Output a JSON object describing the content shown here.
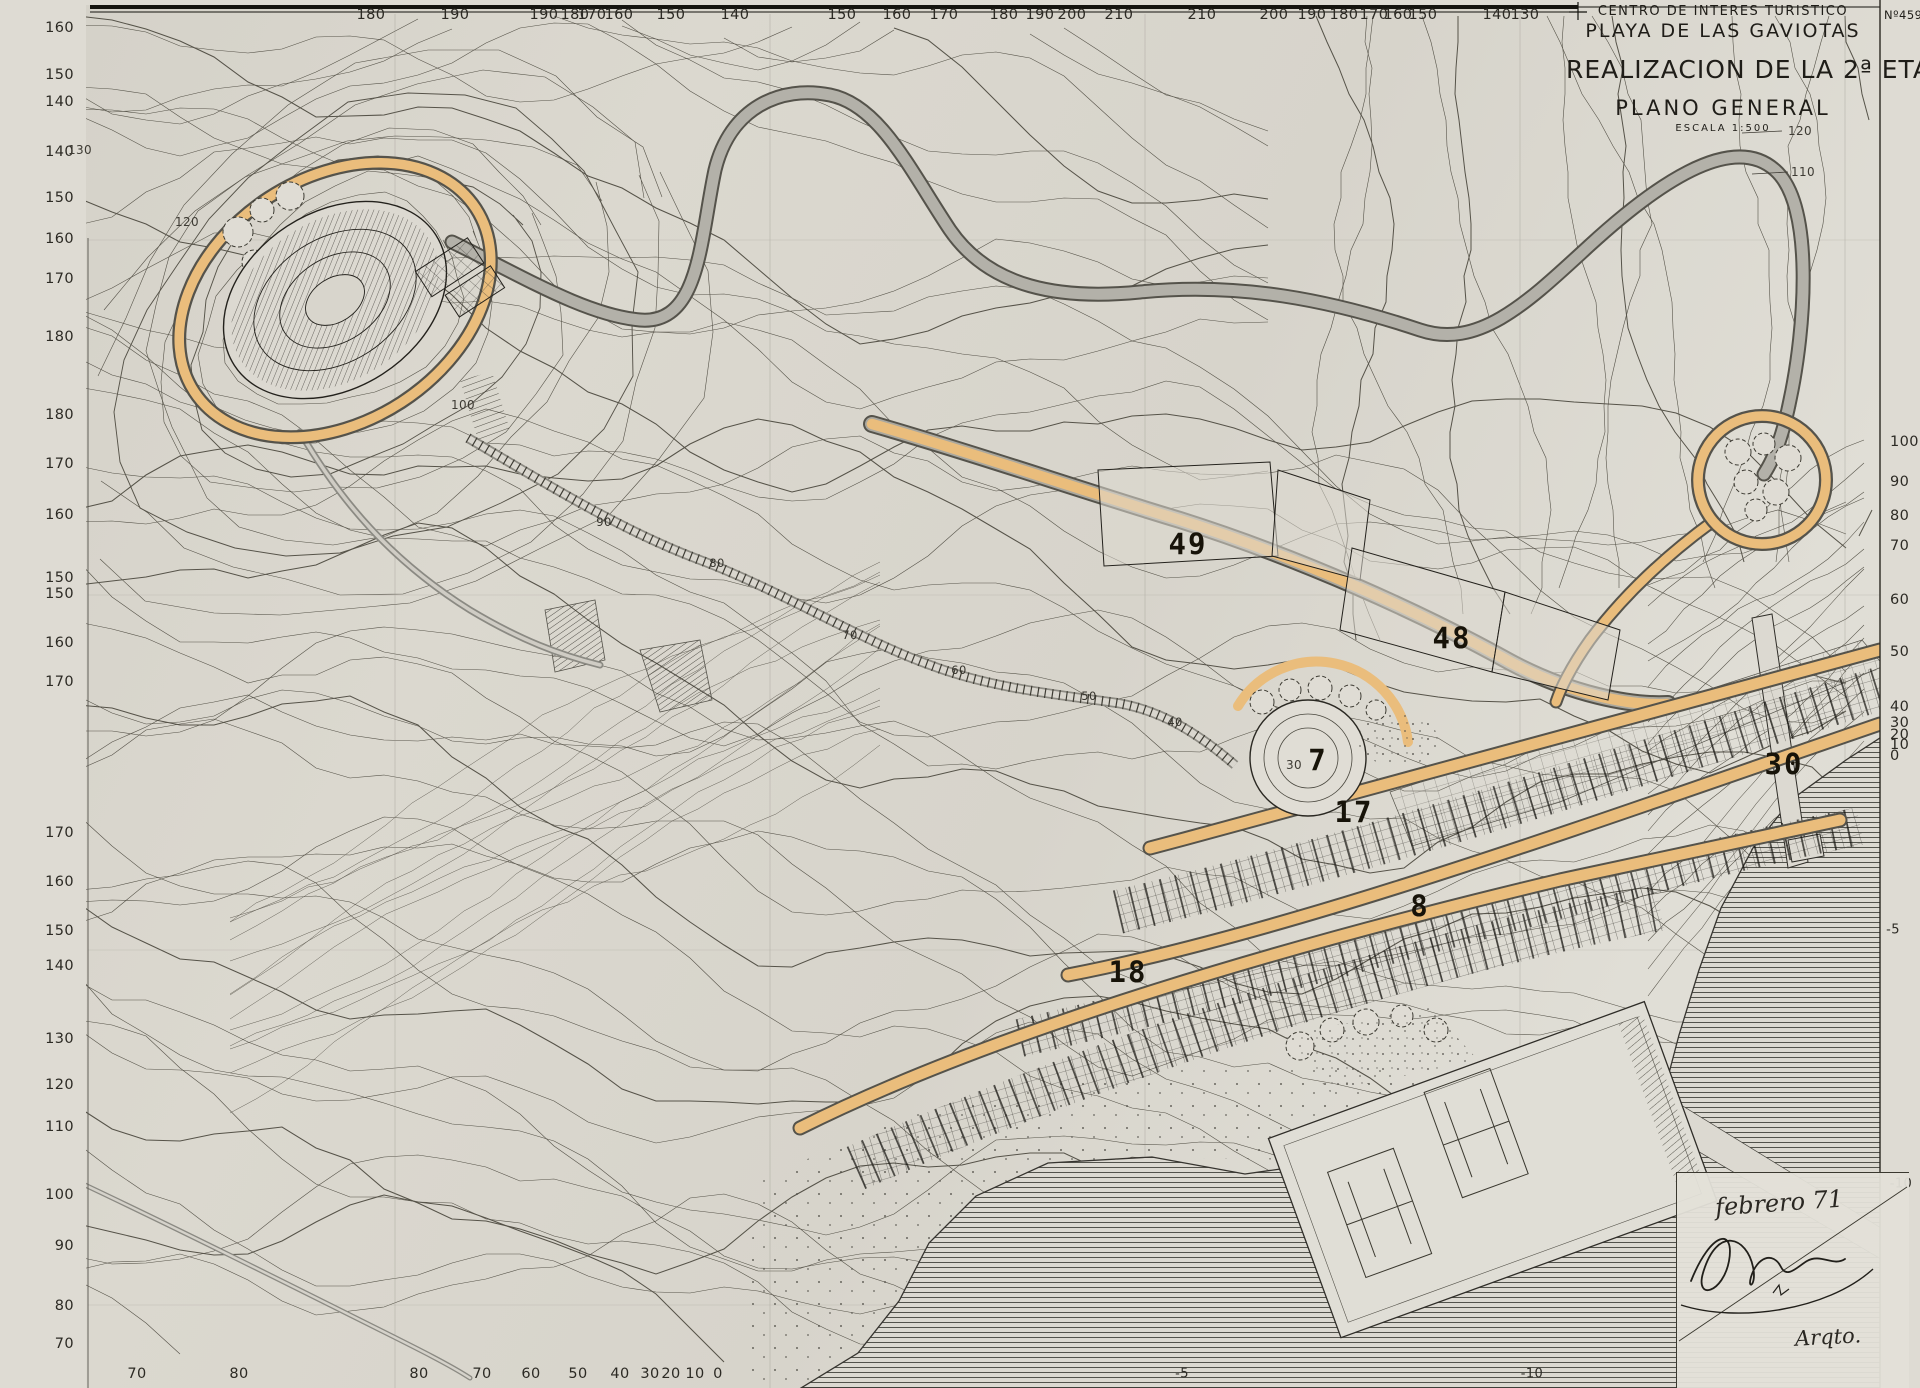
{
  "colors": {
    "paper": "#d8d5cc",
    "paper_light": "#e2dfd7",
    "margin": "#dedbd3",
    "ink": "#1f1d18",
    "contour": "#565349",
    "contour_index": "#45433b",
    "orange": "#eabd7c",
    "road_gray": "#aaa89f",
    "road_dark": "#55534b",
    "sea_line": "#43423c",
    "label": "#2c2a24",
    "stencil": "#171309"
  },
  "title_block": {
    "sheet_number": "Nº459",
    "line1": "CENTRO DE INTERES TURISTICO",
    "line2": "PLAYA DE LAS GAVIOTAS",
    "line3": "REALIZACION DE LA 2ª ETAPA",
    "line4": "PLANO GENERAL",
    "scale": "ESCALA 1:500"
  },
  "signature_block": {
    "date": "febrero 71",
    "credential": "Arqto."
  },
  "labels": {
    "top": [
      {
        "text": "180",
        "x": 371,
        "y": 15
      },
      {
        "text": "190",
        "x": 455,
        "y": 15
      },
      {
        "text": "190",
        "x": 544,
        "y": 15
      },
      {
        "text": "180",
        "x": 575,
        "y": 15
      },
      {
        "text": "170",
        "x": 592,
        "y": 15
      },
      {
        "text": "160",
        "x": 619,
        "y": 15
      },
      {
        "text": "150",
        "x": 671,
        "y": 15
      },
      {
        "text": "140",
        "x": 735,
        "y": 15
      },
      {
        "text": "150",
        "x": 842,
        "y": 15
      },
      {
        "text": "160",
        "x": 897,
        "y": 15
      },
      {
        "text": "170",
        "x": 944,
        "y": 15
      },
      {
        "text": "180",
        "x": 1004,
        "y": 15
      },
      {
        "text": "190",
        "x": 1040,
        "y": 15
      },
      {
        "text": "200",
        "x": 1072,
        "y": 15
      },
      {
        "text": "210",
        "x": 1119,
        "y": 15
      },
      {
        "text": "210",
        "x": 1202,
        "y": 15
      },
      {
        "text": "200",
        "x": 1274,
        "y": 15
      },
      {
        "text": "190",
        "x": 1312,
        "y": 15
      },
      {
        "text": "180",
        "x": 1344,
        "y": 15
      },
      {
        "text": "170",
        "x": 1374,
        "y": 15
      },
      {
        "text": "160",
        "x": 1398,
        "y": 15
      },
      {
        "text": "150",
        "x": 1423,
        "y": 15
      },
      {
        "text": "140",
        "x": 1497,
        "y": 15
      },
      {
        "text": "130",
        "x": 1525,
        "y": 15
      }
    ],
    "left": [
      {
        "text": "160",
        "x": 74,
        "y": 28
      },
      {
        "text": "150",
        "x": 74,
        "y": 75
      },
      {
        "text": "140",
        "x": 74,
        "y": 102
      },
      {
        "text": "140",
        "x": 74,
        "y": 152
      },
      {
        "text": "150",
        "x": 74,
        "y": 198
      },
      {
        "text": "160",
        "x": 74,
        "y": 239
      },
      {
        "text": "170",
        "x": 74,
        "y": 279
      },
      {
        "text": "180",
        "x": 74,
        "y": 337
      },
      {
        "text": "180",
        "x": 74,
        "y": 415
      },
      {
        "text": "170",
        "x": 74,
        "y": 464
      },
      {
        "text": "160",
        "x": 74,
        "y": 515
      },
      {
        "text": "150",
        "x": 74,
        "y": 578
      },
      {
        "text": "150",
        "x": 74,
        "y": 594
      },
      {
        "text": "160",
        "x": 74,
        "y": 643
      },
      {
        "text": "170",
        "x": 74,
        "y": 682
      },
      {
        "text": "170",
        "x": 74,
        "y": 833
      },
      {
        "text": "160",
        "x": 74,
        "y": 882
      },
      {
        "text": "150",
        "x": 74,
        "y": 931
      },
      {
        "text": "140",
        "x": 74,
        "y": 966
      },
      {
        "text": "130",
        "x": 74,
        "y": 1039
      },
      {
        "text": "120",
        "x": 74,
        "y": 1085
      },
      {
        "text": "110",
        "x": 74,
        "y": 1127
      },
      {
        "text": "100",
        "x": 74,
        "y": 1195
      },
      {
        "text": "90",
        "x": 74,
        "y": 1246
      },
      {
        "text": "80",
        "x": 74,
        "y": 1306
      },
      {
        "text": "70",
        "x": 74,
        "y": 1344
      }
    ],
    "right": [
      {
        "text": "100",
        "x": 1890,
        "y": 442
      },
      {
        "text": "90",
        "x": 1890,
        "y": 482
      },
      {
        "text": "80",
        "x": 1890,
        "y": 516
      },
      {
        "text": "70",
        "x": 1890,
        "y": 546
      },
      {
        "text": "60",
        "x": 1890,
        "y": 600
      },
      {
        "text": "50",
        "x": 1890,
        "y": 652
      },
      {
        "text": "40",
        "x": 1890,
        "y": 707
      },
      {
        "text": "30",
        "x": 1890,
        "y": 723
      },
      {
        "text": "20",
        "x": 1890,
        "y": 735
      },
      {
        "text": "10",
        "x": 1890,
        "y": 745
      },
      {
        "text": "0",
        "x": 1890,
        "y": 756
      }
    ],
    "bottom": [
      {
        "text": "70",
        "x": 137,
        "y": 1374
      },
      {
        "text": "80",
        "x": 239,
        "y": 1374
      },
      {
        "text": "80",
        "x": 419,
        "y": 1374
      },
      {
        "text": "70",
        "x": 482,
        "y": 1374
      },
      {
        "text": "60",
        "x": 531,
        "y": 1374
      },
      {
        "text": "50",
        "x": 578,
        "y": 1374
      },
      {
        "text": "40",
        "x": 620,
        "y": 1374
      },
      {
        "text": "30",
        "x": 650,
        "y": 1374
      },
      {
        "text": "20",
        "x": 671,
        "y": 1374
      },
      {
        "text": "10",
        "x": 695,
        "y": 1374
      },
      {
        "text": "0",
        "x": 718,
        "y": 1374
      }
    ],
    "plots": [
      {
        "text": "49",
        "x": 1188,
        "y": 544
      },
      {
        "text": "48",
        "x": 1452,
        "y": 638
      },
      {
        "text": "7",
        "x": 1318,
        "y": 760
      },
      {
        "text": "17",
        "x": 1354,
        "y": 812
      },
      {
        "text": "8",
        "x": 1420,
        "y": 906
      },
      {
        "text": "18",
        "x": 1128,
        "y": 972
      },
      {
        "text": "30",
        "x": 1784,
        "y": 764
      }
    ],
    "funicular": [
      {
        "text": "90",
        "x": 604,
        "y": 522
      },
      {
        "text": "80",
        "x": 717,
        "y": 563
      },
      {
        "text": "70",
        "x": 850,
        "y": 635
      },
      {
        "text": "60",
        "x": 959,
        "y": 670
      },
      {
        "text": "50",
        "x": 1089,
        "y": 696
      },
      {
        "text": "40",
        "x": 1175,
        "y": 722
      }
    ],
    "inline": [
      {
        "text": "130",
        "x": 80,
        "y": 150
      },
      {
        "text": "120",
        "x": 187,
        "y": 222
      },
      {
        "text": "100",
        "x": 463,
        "y": 405
      },
      {
        "text": "120",
        "x": 1800,
        "y": 131
      },
      {
        "text": "110",
        "x": 1803,
        "y": 172
      },
      {
        "text": "30",
        "x": 1294,
        "y": 765
      }
    ],
    "sea": [
      {
        "text": "-5",
        "x": 1182,
        "y": 1374
      },
      {
        "text": "-10",
        "x": 1532,
        "y": 1374
      },
      {
        "text": "-5",
        "x": 1893,
        "y": 930
      },
      {
        "text": "-10",
        "x": 1901,
        "y": 1184
      }
    ]
  }
}
